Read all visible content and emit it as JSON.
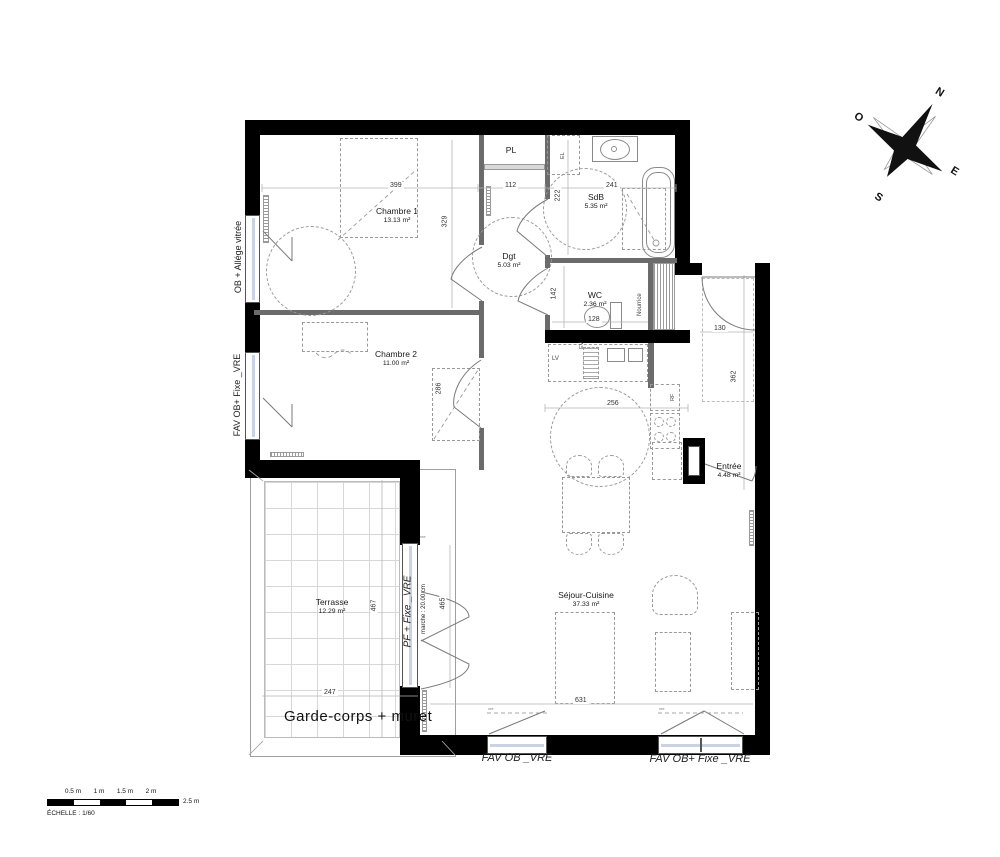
{
  "plan": {
    "rooms": {
      "chambre1": {
        "name": "Chambre 1",
        "area": "13.13 m²"
      },
      "chambre2": {
        "name": "Chambre 2",
        "area": "11.00 m²"
      },
      "dgt": {
        "name": "Dgt",
        "area": "5.03 m²"
      },
      "sdb": {
        "name": "SdB",
        "area": "5.35 m²"
      },
      "wc": {
        "name": "WC",
        "area": "2.36 m²"
      },
      "entree": {
        "name": "Entrée",
        "area": "4.48 m²"
      },
      "sejour": {
        "name": "Séjour-Cuisine",
        "area": "37.33 m²"
      },
      "terrasse": {
        "name": "Terrasse",
        "area": "12.29 m²"
      },
      "pl": {
        "name": "PL"
      }
    },
    "annotations": {
      "nourrice": "Nourrice",
      "garde_corps": "Garde-corps + muret",
      "marche": "marche : 20.00 cm",
      "lv": "LV",
      "ev": "EV",
      "rf": "RF",
      "el": "EL",
      "vre": "vre"
    },
    "windows": {
      "left_top": "OB + Allége vitrée",
      "left_mid": "FAV OB+ Fixe _VRE",
      "terrace_door": "PF + Fixe _VRE",
      "bottom_left": "FAV OB _VRE",
      "bottom_right": "FAV OB+ Fixe _VRE"
    },
    "dimensions": {
      "d399": "399",
      "d112": "112",
      "d241": "241",
      "d329": "329",
      "d222": "222",
      "d142": "142",
      "d128": "128",
      "d130": "130",
      "d362": "362",
      "d256": "256",
      "d286": "286",
      "d247": "247",
      "d467": "467",
      "d465": "465",
      "d631": "631"
    }
  },
  "compass": {
    "n": "N",
    "e": "E",
    "s": "S",
    "o": "O"
  },
  "scalebar": {
    "labels": [
      "0.5 m",
      "1 m",
      "1.5 m",
      "2 m",
      "2.5 m"
    ],
    "caption_label": "ÉCHELLE :",
    "caption_value": "1/60"
  }
}
